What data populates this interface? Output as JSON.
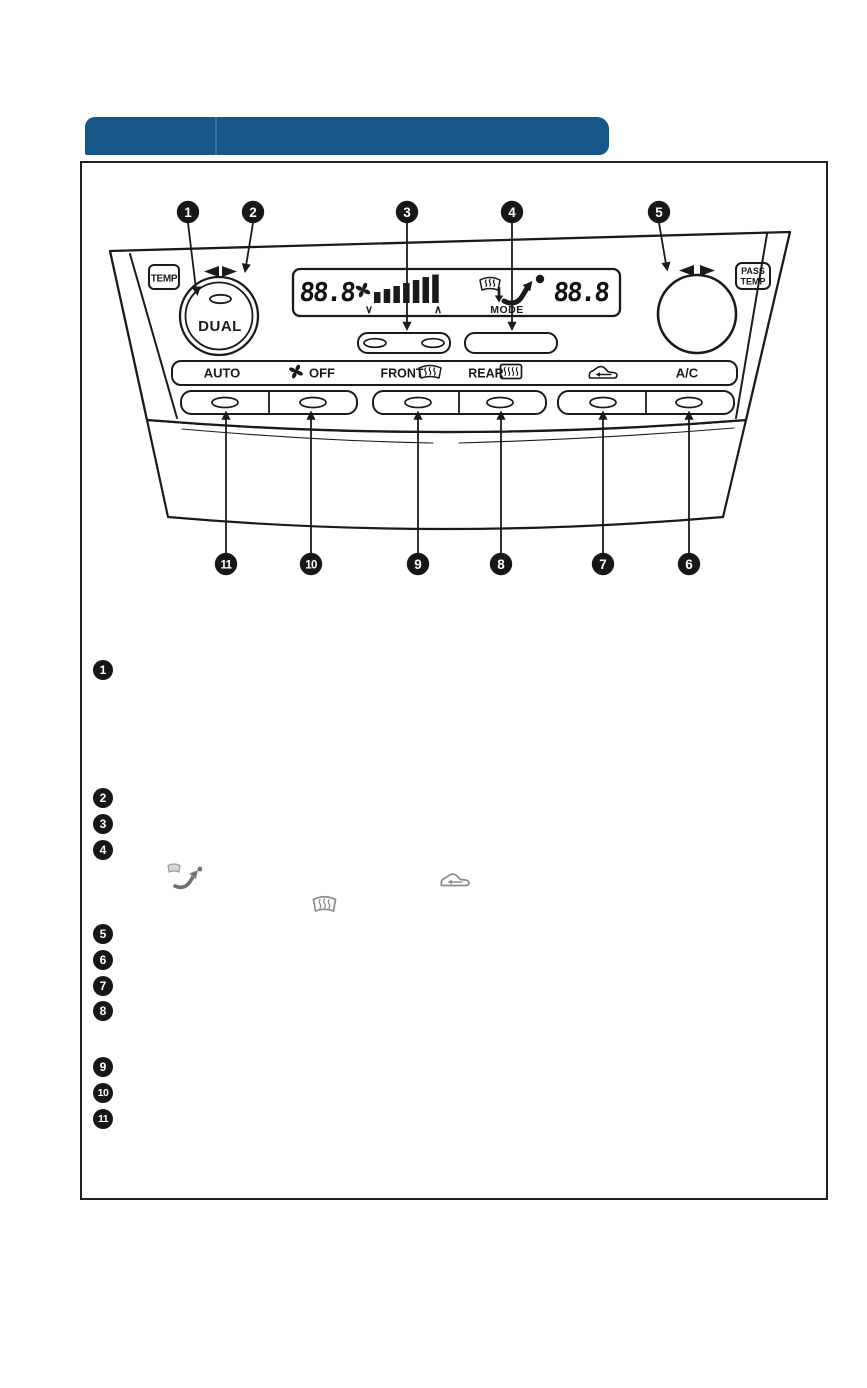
{
  "page": {
    "type": "owners-manual-figure-page",
    "background": "#ffffff"
  },
  "header": {
    "bar_color": "#165689"
  },
  "figure": {
    "panel": {
      "driver_temp_badge": "TEMP",
      "passenger_temp_badge_line1": "PASS",
      "passenger_temp_badge_line2": "TEMP",
      "dual_knob_label": "DUAL",
      "display": {
        "driver_temp_value": "88.8",
        "passenger_temp_value": "88.8",
        "fan_down_chevron": "∨",
        "fan_up_chevron": "∧",
        "mode_label": "MODE"
      },
      "button_labels": {
        "auto": "AUTO",
        "off": "OFF",
        "front": "FRONT",
        "rear": "REAR",
        "ac": "A/C"
      }
    },
    "callouts": {
      "top": [
        "1",
        "2",
        "3",
        "4",
        "5"
      ],
      "bottom": [
        "11",
        "10",
        "9",
        "8",
        "7",
        "6"
      ]
    }
  },
  "legend": {
    "markers": [
      "1",
      "2",
      "3",
      "4",
      "5",
      "6",
      "7",
      "8",
      "9",
      "10",
      "11"
    ]
  },
  "icons": {
    "rotate_arrows": "rotate-arrows-icon",
    "fan": "fan-icon",
    "fan_speed_bars": "fan-speed-bars",
    "windshield_defrost": "windshield-defrost-icon",
    "airflow_mode": "airflow-mode-arrow-icon",
    "front_defrost": "front-defrost-icon",
    "rear_defrost": "rear-defrost-icon",
    "recirculation": "recirculation-icon"
  }
}
